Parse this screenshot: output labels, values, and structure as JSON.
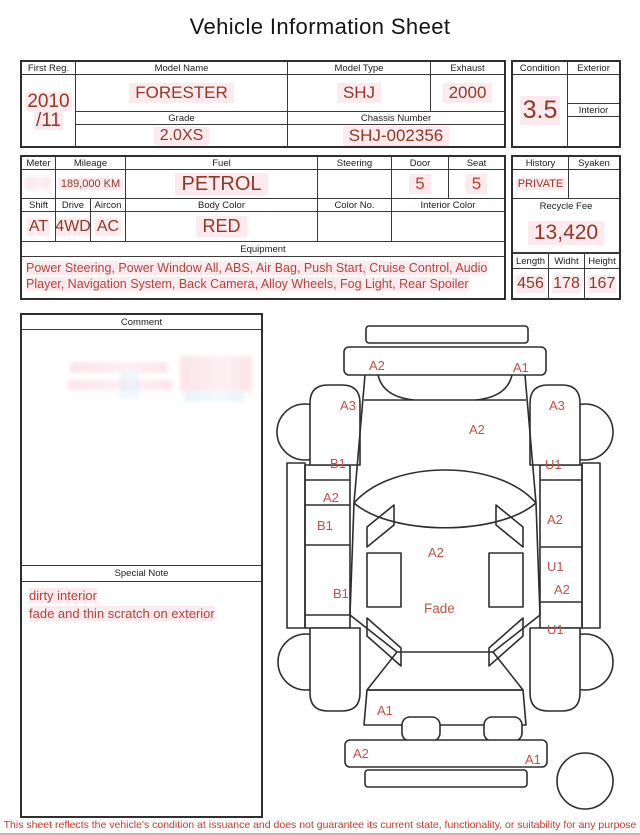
{
  "title": "Vehicle Information Sheet",
  "colors": {
    "value_red": "#8e3a26",
    "bright_red": "#c0392b",
    "diagram_label_red": "#c0524a",
    "highlight_pink": "#fdeaee",
    "border_dark": "#2f2f2f"
  },
  "top_table": {
    "first_reg_label": "First Reg.",
    "first_reg_line1": "2010",
    "first_reg_line2": "/11",
    "model_name_label": "Model Name",
    "model_name_value": "FORESTER",
    "model_type_label": "Model Type",
    "model_type_value": "SHJ",
    "exhaust_label": "Exhaust",
    "exhaust_value": "2000",
    "grade_label": "Grade",
    "grade_value": "2.0XS",
    "chassis_label": "Chassis Number",
    "chassis_value": "SHJ-002356"
  },
  "condition_panel": {
    "condition_label": "Condition",
    "condition_value": "3.5",
    "exterior_label": "Exterior",
    "interior_label": "Interior"
  },
  "spec_table": {
    "meter_label": "Meter",
    "mileage_label": "Mileage",
    "mileage_value": "189,000 KM",
    "fuel_label": "Fuel",
    "fuel_value": "PETROL",
    "steering_label": "Steering",
    "door_label": "Door",
    "door_value": "5",
    "seat_label": "Seat",
    "seat_value": "5",
    "shift_label": "Shift",
    "shift_value": "AT",
    "drive_label": "Drive",
    "drive_value": "4WD",
    "aircon_label": "Aircon",
    "aircon_value": "AC",
    "body_color_label": "Body Color",
    "body_color_value": "RED",
    "color_no_label": "Color No.",
    "interior_color_label": "Interior Color",
    "equipment_label": "Equipment",
    "equipment_value": "Power Steering, Power Window  All, ABS, Air Bag, Push Start, Cruise Control, Audio Player, Navigation System, Back Camera, Alloy Wheels, Fog Light, Rear Spoiler"
  },
  "right_panel": {
    "history_label": "History",
    "history_value": "PRIVATE",
    "syaken_label": "Syaken",
    "recycle_fee_label": "Recycle Fee",
    "recycle_fee_value": "13,420",
    "length_label": "Length",
    "length_value": "456",
    "width_label": "Widht",
    "width_value": "178",
    "height_label": "Height",
    "height_value": "167"
  },
  "comment_section": {
    "comment_label": "Comment",
    "special_note_label": "Special Note",
    "special_note_line1": "dirty interior",
    "special_note_line2": "fade and thin scratch on exterior"
  },
  "diagram": {
    "labels": [
      {
        "t": "A2",
        "x": 103,
        "y": 57
      },
      {
        "t": "A1",
        "x": 247,
        "y": 59
      },
      {
        "t": "A3",
        "x": 74,
        "y": 97
      },
      {
        "t": "A3",
        "x": 283,
        "y": 97
      },
      {
        "t": "A2",
        "x": 203,
        "y": 121
      },
      {
        "t": "B1",
        "x": 64,
        "y": 155
      },
      {
        "t": "U1",
        "x": 279,
        "y": 156
      },
      {
        "t": "A2",
        "x": 57,
        "y": 189
      },
      {
        "t": "B1",
        "x": 51,
        "y": 217
      },
      {
        "t": "A2",
        "x": 281,
        "y": 211
      },
      {
        "t": "A2",
        "x": 162,
        "y": 244
      },
      {
        "t": "U1",
        "x": 281,
        "y": 258
      },
      {
        "t": "A2",
        "x": 288,
        "y": 281
      },
      {
        "t": "B1",
        "x": 67,
        "y": 285
      },
      {
        "t": "Fade",
        "x": 158,
        "y": 300
      },
      {
        "t": "U1",
        "x": 281,
        "y": 321
      },
      {
        "t": "A1",
        "x": 111,
        "y": 402
      },
      {
        "t": "A2",
        "x": 87,
        "y": 445
      },
      {
        "t": "A1",
        "x": 259,
        "y": 451
      }
    ]
  },
  "footer": {
    "disclaimer": "This sheet reflects the vehicle's condition at issuance and does not guarantee its current state, functionality, or suitability for any purpose"
  }
}
